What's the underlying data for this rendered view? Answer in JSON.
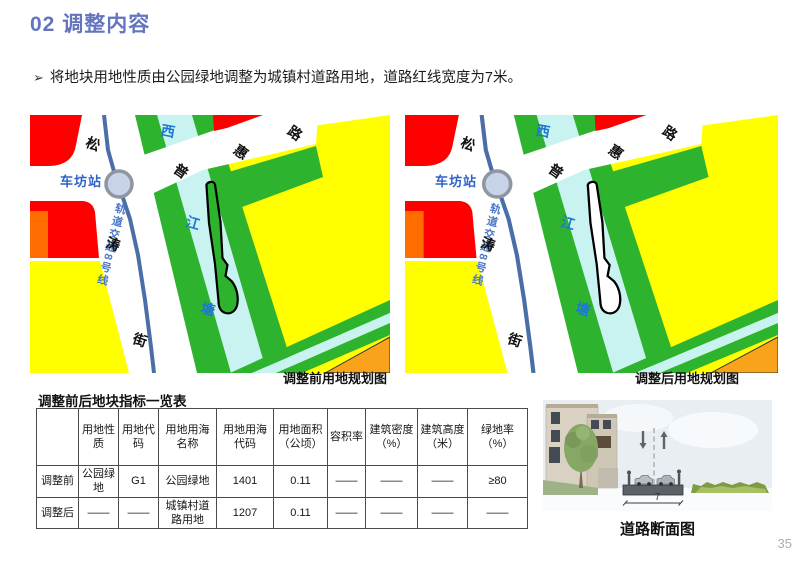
{
  "header": {
    "title": "02 调整内容"
  },
  "bullet": {
    "marker": "➢",
    "text": "将地块用地性质由公园绿地调整为城镇村道路用地，道路红线宽度为7米。"
  },
  "maps": {
    "before": {
      "caption": "调整前用地规划图"
    },
    "after": {
      "caption": "调整后用地规划图"
    },
    "labels": {
      "station": "车坊站",
      "metro": "轨道交通8号线",
      "road_ns": [
        "松",
        "涛",
        "街"
      ],
      "road_ne": [
        "普",
        "惠",
        "路"
      ],
      "river": [
        "西",
        "江",
        "塘"
      ]
    },
    "colors": {
      "red": "#fe0000",
      "orange_left": "#ff6d00",
      "orange_corner": "#f9a21c",
      "yellow": "#ffff00",
      "green": "#2db32d",
      "water": "#c8f3f0",
      "metro_blue": "#4a6fa8",
      "parcel_outline": "#000000",
      "parcel_fill_after": "#ffffff"
    }
  },
  "table": {
    "title": "调整前后地块指标一览表",
    "headers": [
      "",
      "用地性质",
      "用地代码",
      "用地用海名称",
      "用地用海代码",
      "用地面积（公顷）",
      "容积率",
      "建筑密度（%）",
      "建筑高度（米）",
      "绿地率（%）"
    ],
    "rows": [
      {
        "label": "调整前",
        "cells": [
          "公园绿地",
          "G1",
          "公园绿地",
          "1401",
          "0.11",
          "——",
          "——",
          "——",
          "≥80"
        ]
      },
      {
        "label": "调整后",
        "cells": [
          "——",
          "——",
          "城镇村道路用地",
          "1207",
          "0.11",
          "——",
          "——",
          "——",
          "——"
        ]
      }
    ]
  },
  "section": {
    "caption": "道路断面图",
    "dimension": "7",
    "icons": {
      "down": "down-arrow",
      "up": "up-arrow"
    }
  },
  "page": {
    "number": "35"
  }
}
